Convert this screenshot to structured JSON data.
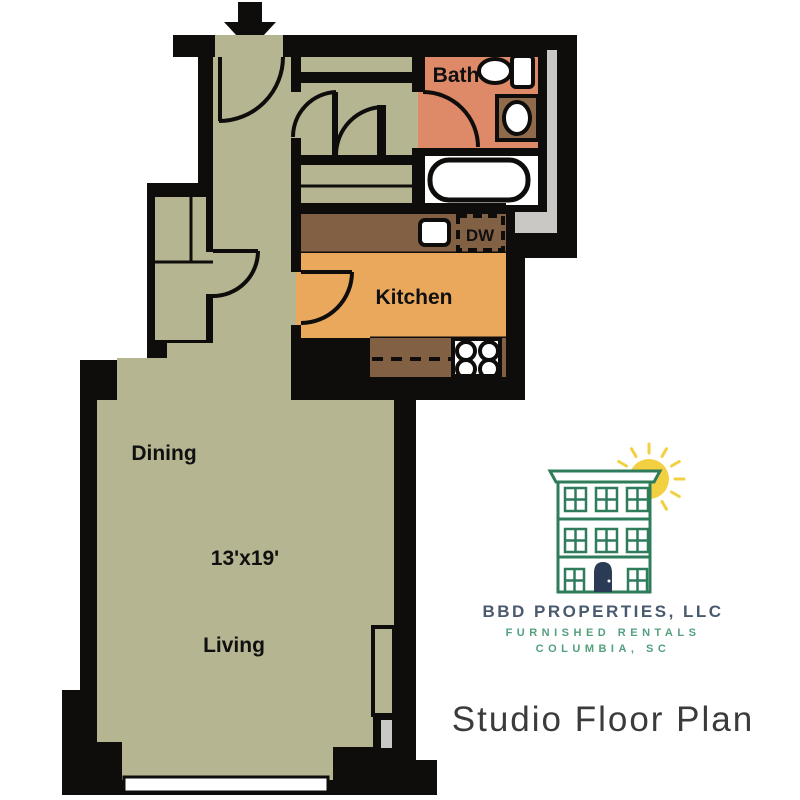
{
  "colors": {
    "wall": "#0e0d0b",
    "sage": "#b6b591",
    "salmon": "#de8a68",
    "orange": "#eaa85d",
    "counter": "#826044",
    "vanity": "#8f6b4b",
    "shaft": "#c9c8c4",
    "logo-green": "#2f7c5b",
    "door-navy": "#2b3a55",
    "sun-yellow": "#f2d042",
    "brand-slate": "#4a5a6e",
    "brand-green": "#53a07e",
    "title-ink": "#3b3b3b"
  },
  "plan": {
    "rooms": {
      "bath": "Bath",
      "kitchen": "Kitchen",
      "dining": "Dining",
      "living": "Living"
    },
    "dimensions": "13'x19'",
    "appliances": {
      "dishwasher": "DW"
    }
  },
  "branding": {
    "company": "BBD PROPERTIES, LLC",
    "tagline": "FURNISHED RENTALS",
    "location": "COLUMBIA, SC",
    "caption": "Studio Floor Plan"
  }
}
